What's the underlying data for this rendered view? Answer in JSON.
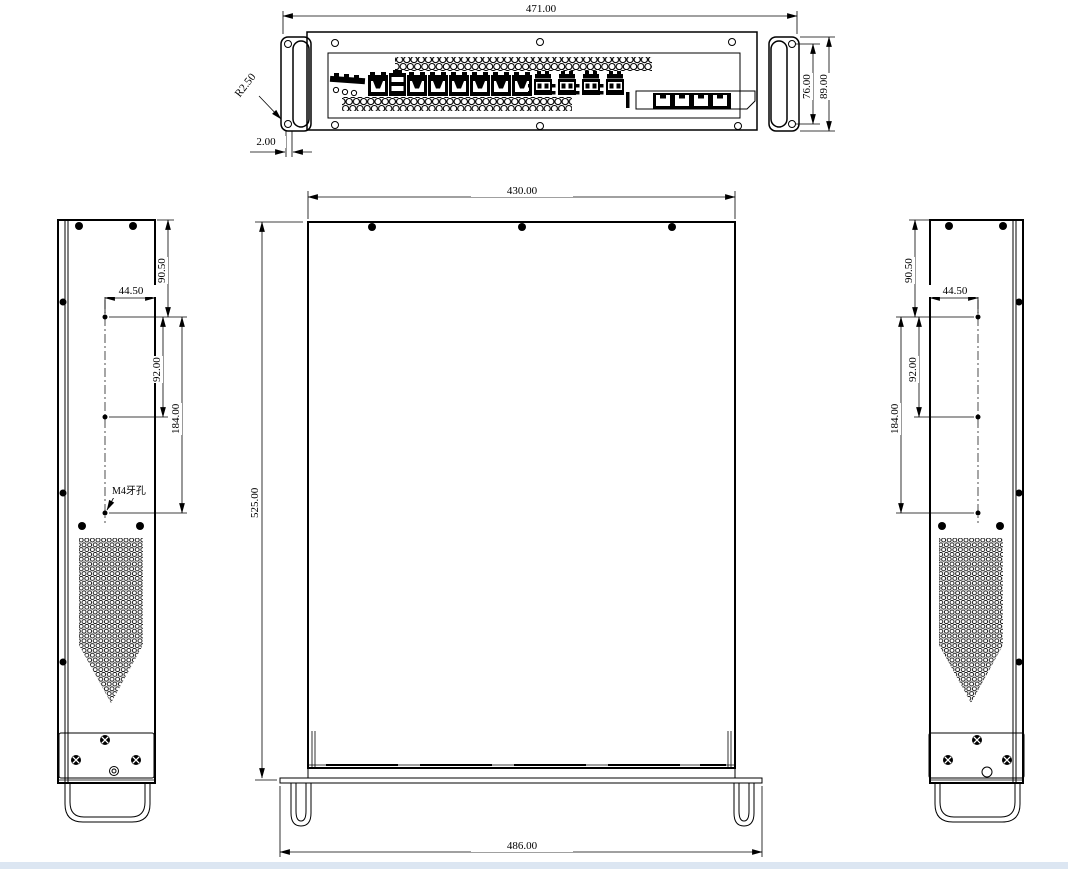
{
  "drawing_labels": {
    "front_view": {
      "overall_width": "471.00",
      "ear_slot_pitch": "76.00",
      "panel_height": "89.00",
      "slot_radius": "R2.50",
      "panel_thickness": "2.00"
    },
    "top_view": {
      "body_width": "430.00",
      "body_depth": "525.00",
      "flange_width": "486.00"
    },
    "left_side_view": {
      "top_hole_offset": "90.50",
      "hole_inset": "44.50",
      "hole_pitch": "92.00",
      "hole_span": "184.00",
      "thread_hole_note": "M4牙孔"
    },
    "right_side_view": {
      "top_hole_offset": "90.50",
      "hole_inset": "44.50",
      "hole_pitch": "92.00",
      "hole_span": "184.00"
    }
  },
  "colors": {
    "line": "#000000",
    "background": "#ffffff",
    "bottom_bar": "#dce6f2"
  }
}
